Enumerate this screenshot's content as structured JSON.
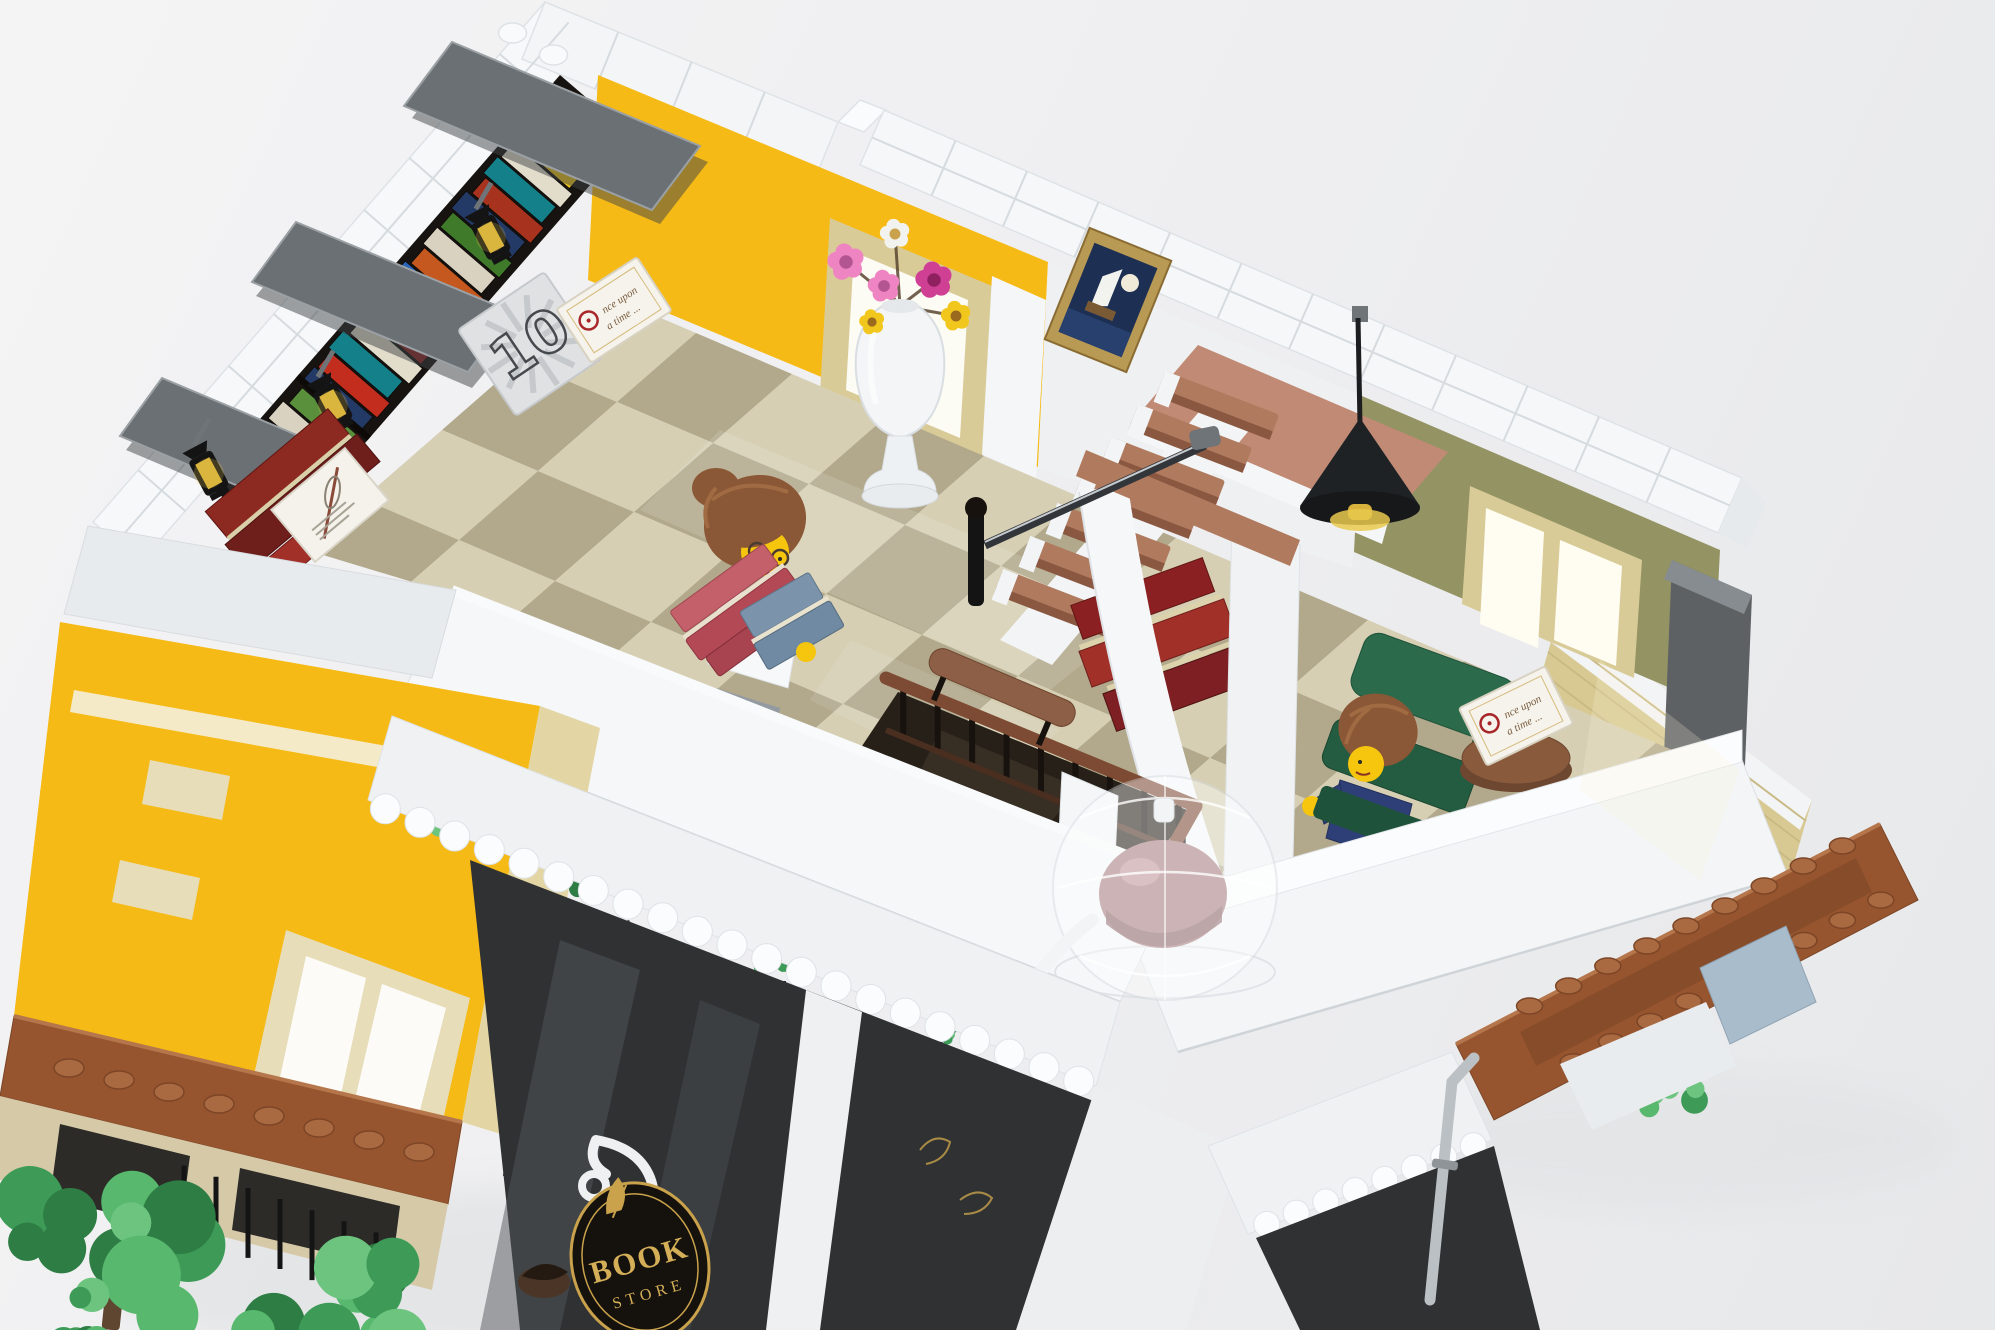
{
  "image": {
    "width": 1995,
    "height": 1330,
    "subject": "lego-bookstore-modular-building-top-floor-render"
  },
  "texts": {
    "price_tile": "10",
    "book_cover_line1": "nce upon",
    "book_cover_line2": "a time ...",
    "sign_word_1": "BOOK",
    "sign_word_2": "STORE"
  },
  "palette": {
    "background": "#eef0f2",
    "white_brick": "#f5f7f9",
    "gray_shade": "#dfe3e6",
    "yellow": "#f6ba17",
    "tan": "#d9cb97",
    "dark_tan": "#cdbd8e",
    "olive": "#949363",
    "floor_light": "#d6cfb4",
    "floor_dark": "#b2a98c",
    "wood_rail": "#7d4b33",
    "nougat": "#b07a5e",
    "mezzanine": "#c08a74",
    "dark_red_book": "#8b2022",
    "shelf_dark": "#171310",
    "sofa_gray": "#5d6164",
    "chair_green": "#2b6a4b",
    "minifig_yellow": "#f6c50e",
    "hair_brown": "#8a5836",
    "cornice_brown": "#96552f",
    "leaf_green": "#3d9b57",
    "sign_black": "#15110d",
    "sign_gold": "#d4af58",
    "lantern_amber": "#d8b13c",
    "glass_smoke": "#2f3133",
    "rose": "#a87e82"
  },
  "decor": {
    "shelf_edges": {
      "out": [
        [
          560,
          75
        ],
        [
          205,
          482
        ]
      ],
      "inn": [
        [
          632,
          137
        ],
        [
          277,
          544
        ]
      ]
    },
    "shelf_books": [
      {
        "t": 0.02,
        "w": 0.04,
        "c": "#c22d1e",
        "i0": 0.08,
        "i1": 0.1
      },
      {
        "t": 0.066,
        "w": 0.036,
        "c": "#2a63b8",
        "i0": 0.12,
        "i1": 0.06
      },
      {
        "t": 0.106,
        "w": 0.042,
        "c": "#e8c11c",
        "i0": 0.05,
        "i1": 0.14
      },
      {
        "t": 0.152,
        "w": 0.034,
        "c": "#e2dccb",
        "i0": 0.1,
        "i1": 0.08
      },
      {
        "t": 0.19,
        "w": 0.04,
        "c": "#13808a",
        "i0": 0.07,
        "i1": 0.12
      },
      {
        "t": 0.234,
        "w": 0.038,
        "c": "#a7331f",
        "i0": 0.12,
        "i1": 0.07
      },
      {
        "t": 0.276,
        "w": 0.042,
        "c": "#243a66",
        "i0": 0.06,
        "i1": 0.12
      },
      {
        "t": 0.322,
        "w": 0.036,
        "c": "#3f7a2a",
        "i0": 0.1,
        "i1": 0.08
      },
      {
        "t": 0.362,
        "w": 0.04,
        "c": "#d9d2c0",
        "i0": 0.08,
        "i1": 0.11
      },
      {
        "t": 0.406,
        "w": 0.038,
        "c": "#c4581f",
        "i0": 0.12,
        "i1": 0.06
      },
      {
        "t": 0.448,
        "w": 0.042,
        "c": "#2a63b8",
        "i0": 0.06,
        "i1": 0.13
      },
      {
        "t": 0.494,
        "w": 0.036,
        "c": "#e8c11c",
        "i0": 0.1,
        "i1": 0.07
      },
      {
        "t": 0.534,
        "w": 0.04,
        "c": "#8b2022",
        "i0": 0.08,
        "i1": 0.1
      },
      {
        "t": 0.578,
        "w": 0.038,
        "c": "#e2dccb",
        "i0": 0.12,
        "i1": 0.06
      },
      {
        "t": 0.62,
        "w": 0.042,
        "c": "#13808a",
        "i0": 0.05,
        "i1": 0.13
      },
      {
        "t": 0.666,
        "w": 0.036,
        "c": "#c22d1e",
        "i0": 0.1,
        "i1": 0.08
      },
      {
        "t": 0.706,
        "w": 0.04,
        "c": "#243a66",
        "i0": 0.07,
        "i1": 0.12
      },
      {
        "t": 0.75,
        "w": 0.038,
        "c": "#5a8f3c",
        "i0": 0.12,
        "i1": 0.07
      },
      {
        "t": 0.792,
        "w": 0.042,
        "c": "#d9d2c0",
        "i0": 0.06,
        "i1": 0.12
      },
      {
        "t": 0.838,
        "w": 0.036,
        "c": "#e8c11c",
        "i0": 0.1,
        "i1": 0.08
      },
      {
        "t": 0.878,
        "w": 0.04,
        "c": "#2a63b8",
        "i0": 0.08,
        "i1": 0.1
      },
      {
        "t": 0.922,
        "w": 0.04,
        "c": "#a7331f",
        "i0": 0.12,
        "i1": 0.06
      }
    ],
    "row_lines": [
      {
        "a": [
          545,
          2
        ],
        "b": [
          93,
          522
        ],
        "a2": [
          592,
          43
        ],
        "b2": [
          140,
          563
        ],
        "n": 10,
        "s": "#d6dbdf",
        "w": 2
      },
      {
        "a": [
          545,
          2
        ],
        "b": [
          592,
          43
        ],
        "a2": [
          93,
          522
        ],
        "b2": [
          140,
          563
        ],
        "n": 2,
        "s": "#d6dbdf",
        "w": 2
      },
      {
        "a": [
          545,
          2
        ],
        "b": [
          838,
          122
        ],
        "a2": [
          522,
          59
        ],
        "b2": [
          815,
          179
        ],
        "n": 4,
        "s": "#d6dbdf",
        "w": 2
      },
      {
        "a": [
          884,
          110
        ],
        "b": [
          1742,
          478
        ],
        "a2": [
          860,
          165
        ],
        "b2": [
          1718,
          533
        ],
        "n": 12,
        "s": "#d6dbdf",
        "w": 2
      },
      {
        "a": [
          884,
          110
        ],
        "b": [
          860,
          165
        ],
        "a2": [
          1742,
          478
        ],
        "b2": [
          1718,
          533
        ],
        "n": 2,
        "s": "#d6dbdf",
        "w": 2
      },
      {
        "a": [
          1048,
          262
        ],
        "b": [
          1038,
          468
        ],
        "a2": [
          1362,
          396
        ],
        "b2": [
          1352,
          568
        ],
        "n": 4,
        "s": "#dce0e3",
        "w": 2
      },
      {
        "a": [
          1362,
          396
        ],
        "b": [
          1354,
          552
        ],
        "a2": [
          1720,
          550
        ],
        "b2": [
          1712,
          706
        ],
        "n": 5,
        "s": "#87865a",
        "w": 2
      },
      {
        "a": [
          598,
          75
        ],
        "b": [
          588,
          280
        ],
        "a2": [
          1048,
          262
        ],
        "b2": [
          1038,
          467
        ],
        "n": 5,
        "s": "#e0a90f",
        "w": 2
      },
      {
        "a": [
          60,
          622
        ],
        "b": [
          14,
          1016
        ],
        "a2": [
          540,
          706
        ],
        "b2": [
          462,
          1122
        ],
        "n": 7,
        "s": "#e0a90f",
        "w": 2
      },
      {
        "a": [
          88,
          526
        ],
        "b": [
          64,
          614
        ],
        "a2": [
          456,
          590
        ],
        "b2": [
          432,
          678
        ],
        "n": 3,
        "s": "#d6dbdf",
        "w": 2
      },
      {
        "a": [
          392,
          716
        ],
        "b": [
          368,
          800
        ],
        "a2": [
          1120,
          1002
        ],
        "b2": [
          1096,
          1086
        ],
        "n": 3,
        "s": "#dde1e4",
        "w": 2
      },
      {
        "a": [
          1560,
          610
        ],
        "b": [
          1536,
          694
        ],
        "a2": [
          1812,
          800
        ],
        "b2": [
          1788,
          884
        ],
        "n": 4,
        "s": "#c9ba85",
        "w": 2
      },
      {
        "a": [
          452,
          590
        ],
        "b": [
          392,
          716
        ],
        "a2": [
          1180,
          876
        ],
        "b2": [
          1120,
          1002
        ],
        "n": 9,
        "s": "#d3d8dc",
        "w": 1.5
      },
      {
        "a": [
          452,
          590
        ],
        "b": [
          1180,
          876
        ],
        "a2": [
          392,
          716
        ],
        "b2": [
          1120,
          1002
        ],
        "n": 3,
        "s": "#d3d8dc",
        "w": 1.5
      },
      {
        "a": [
          1130,
          932
        ],
        "b": [
          1178,
          1052
        ],
        "a2": [
          1742,
          760
        ],
        "b2": [
          1788,
          876
        ],
        "n": 8,
        "s": "#d3d8dc",
        "w": 1.5
      },
      {
        "a": [
          1130,
          932
        ],
        "b": [
          1742,
          760
        ],
        "a2": [
          1178,
          1052
        ],
        "b2": [
          1788,
          876
        ],
        "n": 2,
        "s": "#d3d8dc",
        "w": 1.5
      },
      {
        "a": [
          470,
          860
        ],
        "b": [
          1096,
          1102
        ],
        "a2": [
          520,
          1330
        ],
        "b2": [
          1030,
          1330
        ],
        "n": 4,
        "s": "#0f1011",
        "w": 6
      },
      {
        "a": [
          470,
          860
        ],
        "b": [
          520,
          1330
        ],
        "a2": [
          1096,
          1102
        ],
        "b2": [
          1030,
          1330
        ],
        "n": 3,
        "s": "#0f1011",
        "w": 5
      },
      {
        "a": [
          1256,
          1238
        ],
        "b": [
          1494,
          1146
        ],
        "a2": [
          1300,
          1330
        ],
        "b2": [
          1540,
          1330
        ],
        "n": 3,
        "s": "#101112",
        "w": 5
      }
    ],
    "baluster_runs": [
      {
        "a": [
          886,
          678
        ],
        "b": [
          1196,
          806
        ],
        "n": 9,
        "len": 50,
        "s": "#17120e",
        "w": 6
      },
      {
        "a": [
          1196,
          806
        ],
        "b": [
          1116,
          948
        ],
        "n": 3,
        "len": 46,
        "s": "#17120e",
        "w": 6
      },
      {
        "a": [
          168,
          1160
        ],
        "b": [
          392,
          1238
        ],
        "n": 7,
        "len": 70,
        "s": "#141414",
        "w": 5
      }
    ],
    "scallop_rows": [
      {
        "a": [
          368,
          802
        ],
        "b": [
          1096,
          1088
        ],
        "n": 21,
        "r": 15
      },
      {
        "a": [
          1252,
          1230
        ],
        "b": [
          1488,
          1140
        ],
        "n": 8,
        "r": 13
      }
    ],
    "stud_rows": [
      {
        "a": [
          44,
          1062
        ],
        "b": [
          444,
          1158
        ],
        "n": 8,
        "rx": 15,
        "ry": 9,
        "f": "#a96a42",
        "s": "#7c4526"
      },
      {
        "a": [
          1510,
          1016
        ],
        "b": [
          1862,
          836
        ],
        "n": 9,
        "rx": 13,
        "ry": 8,
        "f": "#a96a42",
        "s": "#7c4526"
      },
      {
        "a": [
          1554,
          1072
        ],
        "b": [
          1900,
          890
        ],
        "n": 9,
        "rx": 13,
        "ry": 8,
        "f": "#a96a42",
        "s": "#7c4526"
      },
      {
        "a": [
          492,
          22
        ],
        "b": [
          574,
          66
        ],
        "n": 2,
        "rx": 14,
        "ry": 10,
        "f": "#f8fafb",
        "s": "#dde2e5"
      }
    ],
    "treads": {
      "n": 7,
      "cx": 1056,
      "cy": 602,
      "dx": 27,
      "dy": -33,
      "w": 122,
      "h": 24,
      "rot": 21
    },
    "checker": {
      "o": [
        600,
        292
      ],
      "us": [
        96,
        41
      ],
      "vs": [
        -79,
        69
      ],
      "ni": 14,
      "nj": 7,
      "light": "#d6cfb4",
      "dark": "#b2a98c"
    },
    "sunburst": {
      "n": 12,
      "r1": 16,
      "r2": 49,
      "s": "#c6c9cc",
      "w": 6
    },
    "flowers": {
      "stem_to": [
        900,
        306
      ],
      "list": [
        {
          "cx": 895,
          "cy": 234,
          "r": 13,
          "c": "#f2f3ef",
          "cc": "#c9a24b"
        },
        {
          "cx": 846,
          "cy": 262,
          "r": 16,
          "c": "#ee85c2",
          "cc": "#b25590"
        },
        {
          "cx": 884,
          "cy": 286,
          "r": 14,
          "c": "#ee85c2",
          "cc": "#b25590"
        },
        {
          "cx": 934,
          "cy": 280,
          "r": 16,
          "c": "#cf3f94",
          "cc": "#8f2060"
        },
        {
          "cx": 956,
          "cy": 316,
          "r": 13,
          "c": "#f2c71d",
          "cc": "#9a6a1f"
        },
        {
          "cx": 872,
          "cy": 322,
          "r": 11,
          "c": "#f2c71d",
          "cc": "#9a6a1f"
        }
      ]
    },
    "foliage": [
      {
        "cx": 118,
        "cy": 1258,
        "n": 12,
        "rmin": 18,
        "rmax": 40,
        "sx": 95,
        "sy": 60
      },
      {
        "cx": 330,
        "cy": 1296,
        "n": 10,
        "rmin": 16,
        "rmax": 34,
        "sx": 80,
        "sy": 48
      },
      {
        "cx": 50,
        "cy": 1316,
        "n": 6,
        "rmin": 10,
        "rmax": 20,
        "sx": 48,
        "sy": 26
      },
      {
        "cx": 1662,
        "cy": 1082,
        "n": 6,
        "rmin": 9,
        "rmax": 18,
        "sx": 42,
        "sy": 26
      },
      {
        "cx": 426,
        "cy": 823,
        "n": 4,
        "rmin": 5,
        "rmax": 9,
        "sx": 16,
        "sy": 10
      },
      {
        "cx": 586,
        "cy": 888,
        "n": 4,
        "rmin": 5,
        "rmax": 9,
        "sx": 16,
        "sy": 10
      },
      {
        "cx": 770,
        "cy": 958,
        "n": 4,
        "rmin": 5,
        "rmax": 9,
        "sx": 16,
        "sy": 10
      },
      {
        "cx": 952,
        "cy": 1030,
        "n": 4,
        "rmin": 5,
        "rmax": 9,
        "sx": 16,
        "sy": 10
      },
      {
        "cx": 1272,
        "cy": 1162,
        "n": 3,
        "rmin": 5,
        "rmax": 8,
        "sx": 14,
        "sy": 9
      },
      {
        "cx": 1372,
        "cy": 1124,
        "n": 3,
        "rmin": 5,
        "rmax": 8,
        "sx": 14,
        "sy": 9
      }
    ],
    "leaf_colors": [
      "#2e7d44",
      "#3d9b57",
      "#57b86e",
      "#6cc47f"
    ],
    "polys": [
      {
        "p": "720,430 1150,610 1050,690 640,510",
        "f": "#ffffff",
        "o": 0.13
      },
      {
        "p": "850,640 1060,730 990,790 810,700",
        "f": "#ffffff",
        "o": 0.1
      },
      {
        "p": "560,940 640,970 560,1330 480,1330",
        "f": "#54585c",
        "o": 0.5
      },
      {
        "p": "700,1000 760,1024 690,1330 630,1330",
        "f": "#494d51",
        "o": 0.5
      },
      {
        "p": "1310,1246 1360,1226 1392,1330 1340,1330",
        "f": "#50545a",
        "o": 0.6
      },
      {
        "p": "1600,660 1740,770 1700,880 1580,790",
        "f": "#fff7d9",
        "o": 0.22
      }
    ]
  }
}
